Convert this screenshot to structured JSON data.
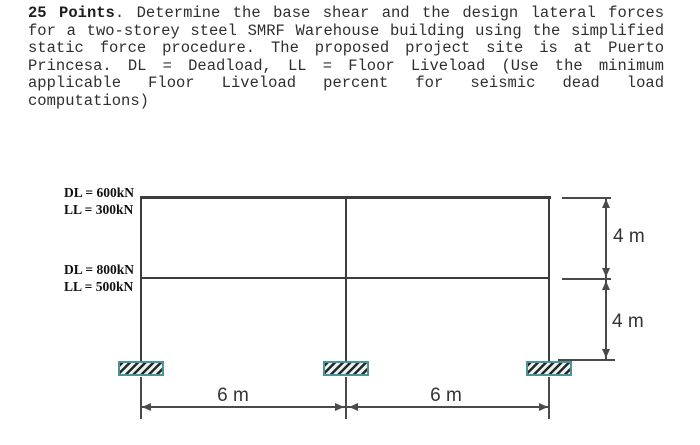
{
  "problem": {
    "heading_bold": "25 Points",
    "line1_rest": ". Determine the base shear and the design lateral forces",
    "lines": [
      "for a two-storey steel SMRF Warehouse building using the simplified",
      "static force procedure. The proposed project site is at Puerto",
      "Princesa. DL = Deadload, LL = Floor Liveload (Use the minimum",
      "applicable Floor Liveload percent for seismic dead load",
      "computations)"
    ]
  },
  "diagram": {
    "loads": {
      "roof_dl": "DL = 600kN",
      "roof_ll": "LL = 300kN",
      "floor_dl": "DL = 800kN",
      "floor_ll": "LL = 500kN"
    },
    "dimensions": {
      "storey_upper": "4 m",
      "storey_lower": "4 m",
      "bay_left": "6 m",
      "bay_right": "6 m"
    }
  },
  "colors": {
    "frame_line": "#3d3d3d",
    "text": "#2f2f2f",
    "load_label": "#101010",
    "dim_text": "#333333",
    "support_border": "#4b9394",
    "support_hatch": "#262626",
    "support_fill": "#e7f1f1"
  }
}
